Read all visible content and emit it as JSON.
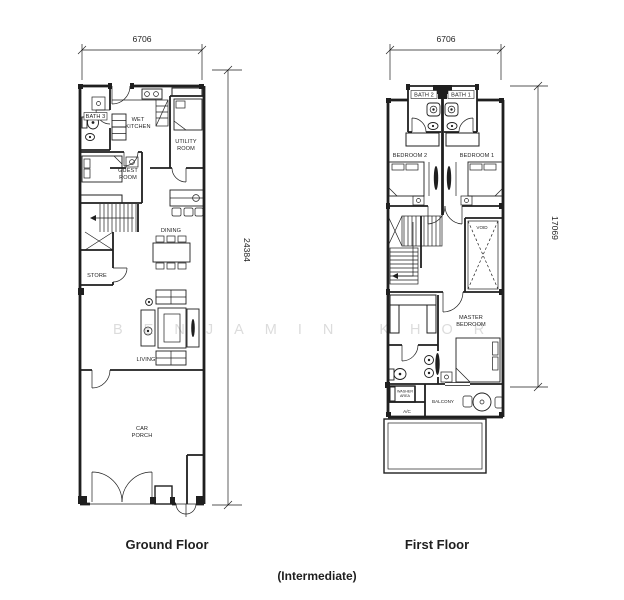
{
  "colors": {
    "ink": "#1f1f1f",
    "watermark": "#dcdcdc",
    "background": "#ffffff"
  },
  "watermark_text": "BENJAMIN KHOR",
  "caption": "(Intermediate)",
  "ground_floor": {
    "title": "Ground Floor",
    "dims": {
      "width": "6706",
      "depth": "24384"
    },
    "rooms": {
      "bath3": "BATH 3",
      "wet_kitchen_1": "WET",
      "wet_kitchen_2": "KITCHEN",
      "utility_1": "UTILITY",
      "utility_2": "ROOM",
      "guest_1": "GUEST",
      "guest_2": "ROOM",
      "dining": "DINING",
      "store": "STORE",
      "living": "LIVING",
      "car_porch_1": "CAR",
      "car_porch_2": "PORCH"
    }
  },
  "first_floor": {
    "title": "First Floor",
    "dims": {
      "width": "6706",
      "depth": "17069"
    },
    "rooms": {
      "bath2": "BATH 2",
      "bath1": "BATH 1",
      "bedroom2": "BEDROOM 2",
      "bedroom1": "BEDROOM 1",
      "void": "VOID",
      "master_1": "MASTER",
      "master_2": "BEDROOM",
      "washer_1": "WASHER",
      "washer_2": "AREA",
      "ac": "A/C",
      "balcony": "BALCONY"
    }
  }
}
